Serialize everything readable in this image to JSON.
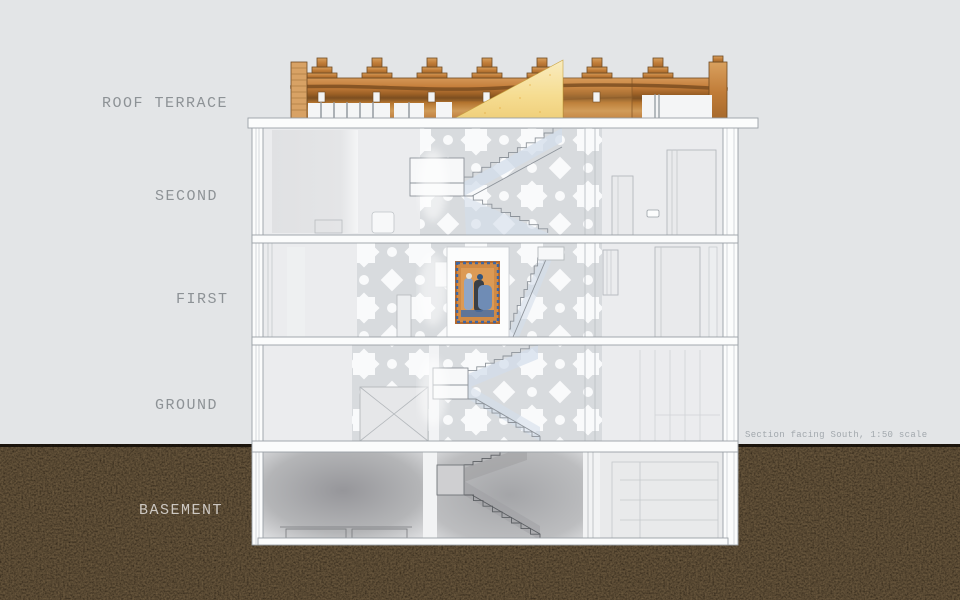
{
  "floors": {
    "roof_terrace": {
      "label": "ROOF TERRACE"
    },
    "second": {
      "label": "SECOND"
    },
    "first": {
      "label": "FIRST"
    },
    "ground": {
      "label": "GROUND"
    },
    "basement": {
      "label": "BASEMENT"
    }
  },
  "caption": {
    "text": "Section facing South, 1:50 scale"
  },
  "colors": {
    "background": "#e3e5e7",
    "label_text": "#8d9296",
    "basement_label_text": "#cdc8c2",
    "caption_text": "#a2a8ad",
    "soil_base": "#140d08",
    "soil_speckle": "#6b4a2a",
    "parapet_wood_light": "#d9a05e",
    "parapet_wood_mid": "#c07c38",
    "parapet_wood_dark": "#7b4e21",
    "sand_triangle": "#f6dd92",
    "slab_white": "#fbfcfc",
    "drawing_line": "#9aa0a6",
    "faint_line": "#c6cacd",
    "stair_glass_blue": "#d3ddeb",
    "pattern_gray": "#d6d9dc",
    "artwork_orange": "#d08a45",
    "artwork_blue": "#6f8cb5"
  }
}
